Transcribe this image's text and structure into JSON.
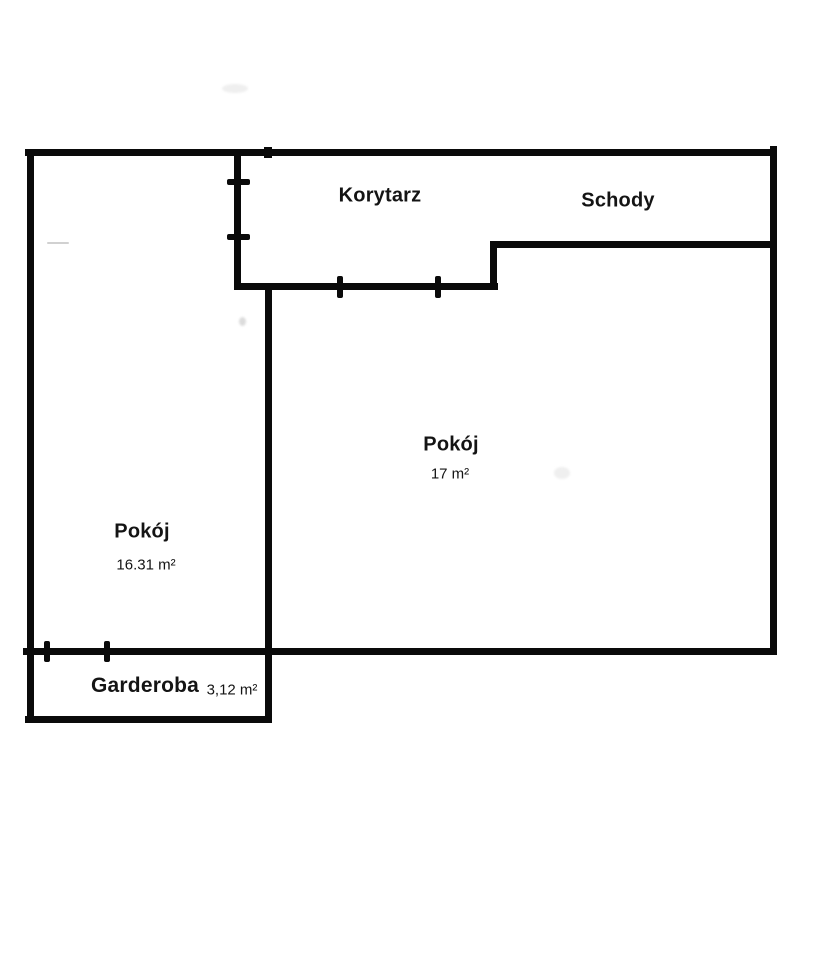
{
  "document": {
    "type": "floor-plan",
    "language": "pl"
  },
  "colors": {
    "wall": "#0a0a0a",
    "background": "#ffffff",
    "text": "#141414"
  },
  "rooms": {
    "korytarz": {
      "name": "Korytarz",
      "area": ""
    },
    "schody": {
      "name": "Schody",
      "area": ""
    },
    "pokoj_main": {
      "name": "Pokój",
      "area": "17 m²"
    },
    "pokoj_left": {
      "name": "Pokój",
      "area": "16.31 m²"
    },
    "garderoba": {
      "name": "Garderoba",
      "area": "3,12 m²"
    }
  }
}
